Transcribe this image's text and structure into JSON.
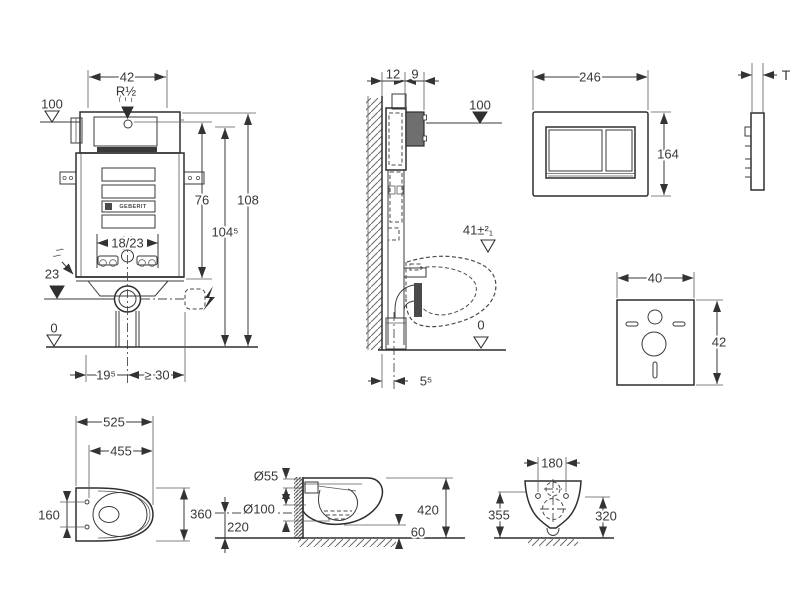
{
  "colors": {
    "line": "#3a3a3a",
    "background": "#ffffff",
    "dark_block": "#6f6f6f",
    "dark_strip": "#3a3a3a"
  },
  "views": {
    "cistern_front": {
      "width": "42",
      "supply_thread": "R½",
      "supply_level": "100",
      "h_center": "76",
      "h_mid": "104⁵",
      "h_top": "108",
      "bolt_spacing": "18/23",
      "outlet_height": "23",
      "floor": "0",
      "outlet_offset": "19⁵",
      "min_clearance": "≥ 30",
      "brand": "GEBERIT"
    },
    "install_side": {
      "wall_offset": "12",
      "cover_depth": "9",
      "supply_level": "100",
      "rim_height": "41±²₁",
      "floor": "0",
      "pipe_offset": "5⁵"
    },
    "flush_plate": {
      "width": "246",
      "height": "164",
      "thickness": "T"
    },
    "sound_mat": {
      "width": "40",
      "height": "42"
    },
    "wc_top": {
      "length": "525",
      "bowl_length": "455",
      "hole_spacing": "160",
      "width": "360"
    },
    "wc_side": {
      "flush_pipe": "Ø55",
      "outlet_pipe": "Ø100",
      "outlet_height": "220",
      "height": "420",
      "clearance": "60"
    },
    "wc_front": {
      "hole_spacing": "180",
      "height_left": "355",
      "height_right": "320"
    }
  }
}
